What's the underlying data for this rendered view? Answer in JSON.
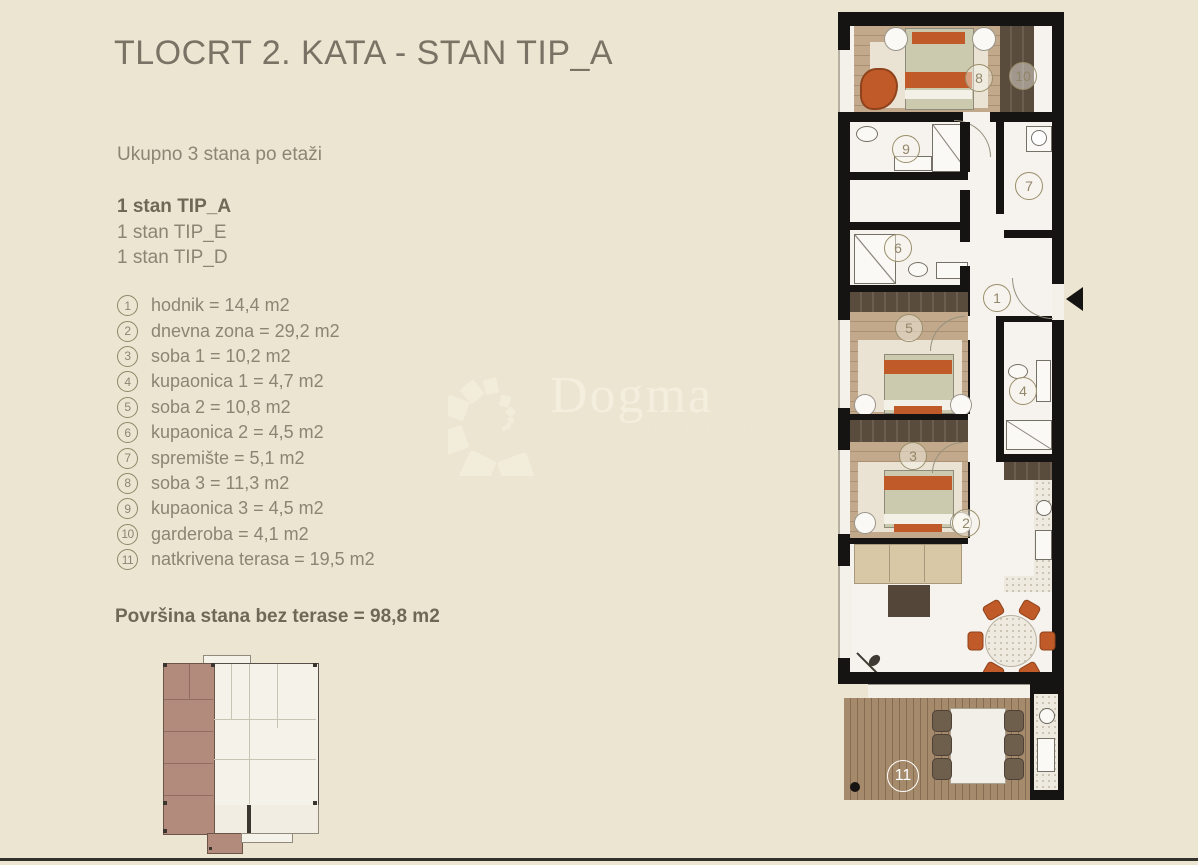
{
  "header": {
    "title": "TLOCRT 2. KATA - STAN TIP_A"
  },
  "summary": {
    "line": "Ukupno 3 stana po etaži",
    "units": [
      {
        "label": "1 stan TIP_A"
      },
      {
        "label": "1 stan TIP_E"
      },
      {
        "label": "1 stan TIP_D"
      }
    ]
  },
  "rooms": [
    {
      "num": "1",
      "label": "hodnik = 14,4 m2"
    },
    {
      "num": "2",
      "label": "dnevna zona = 29,2 m2"
    },
    {
      "num": "3",
      "label": "soba 1 = 10,2 m2"
    },
    {
      "num": "4",
      "label": "kupaonica 1 = 4,7 m2"
    },
    {
      "num": "5",
      "label": "soba 2 = 10,8 m2"
    },
    {
      "num": "6",
      "label": "kupaonica 2 = 4,5 m2"
    },
    {
      "num": "7",
      "label": "spremište = 5,1 m2"
    },
    {
      "num": "8",
      "label": "soba 3 = 11,3 m2"
    },
    {
      "num": "9",
      "label": "kupaonica 3 = 4,5 m2"
    },
    {
      "num": "10",
      "label": "garderoba = 4,1 m2"
    },
    {
      "num": "11",
      "label": "natkrivena terasa = 19,5 m2"
    }
  ],
  "total": {
    "label": "Površina stana bez terase = 98,8 m2"
  },
  "watermark": {
    "brand": "Dogma",
    "sub": "nekretnine"
  },
  "floorplan": {
    "badges": [
      "1",
      "2",
      "3",
      "4",
      "5",
      "6",
      "7",
      "8",
      "9",
      "10",
      "11"
    ]
  },
  "colors": {
    "background": "#ECE5D1",
    "title_text": "#7A7365",
    "body_text": "#8D8573",
    "bold_text": "#6E6956",
    "badge_outline": "#9A8F6B",
    "accent_orange": "#C05A28",
    "wall_black": "#161412",
    "wood_floor": "#C2A98B",
    "dark_wood": "#5A4C3D",
    "marble_white": "#F6F3EE",
    "deck_wood": "#A68A6C",
    "highlight_mauve": "#B38B7D",
    "watermark_cream": "#F3EEDD"
  }
}
